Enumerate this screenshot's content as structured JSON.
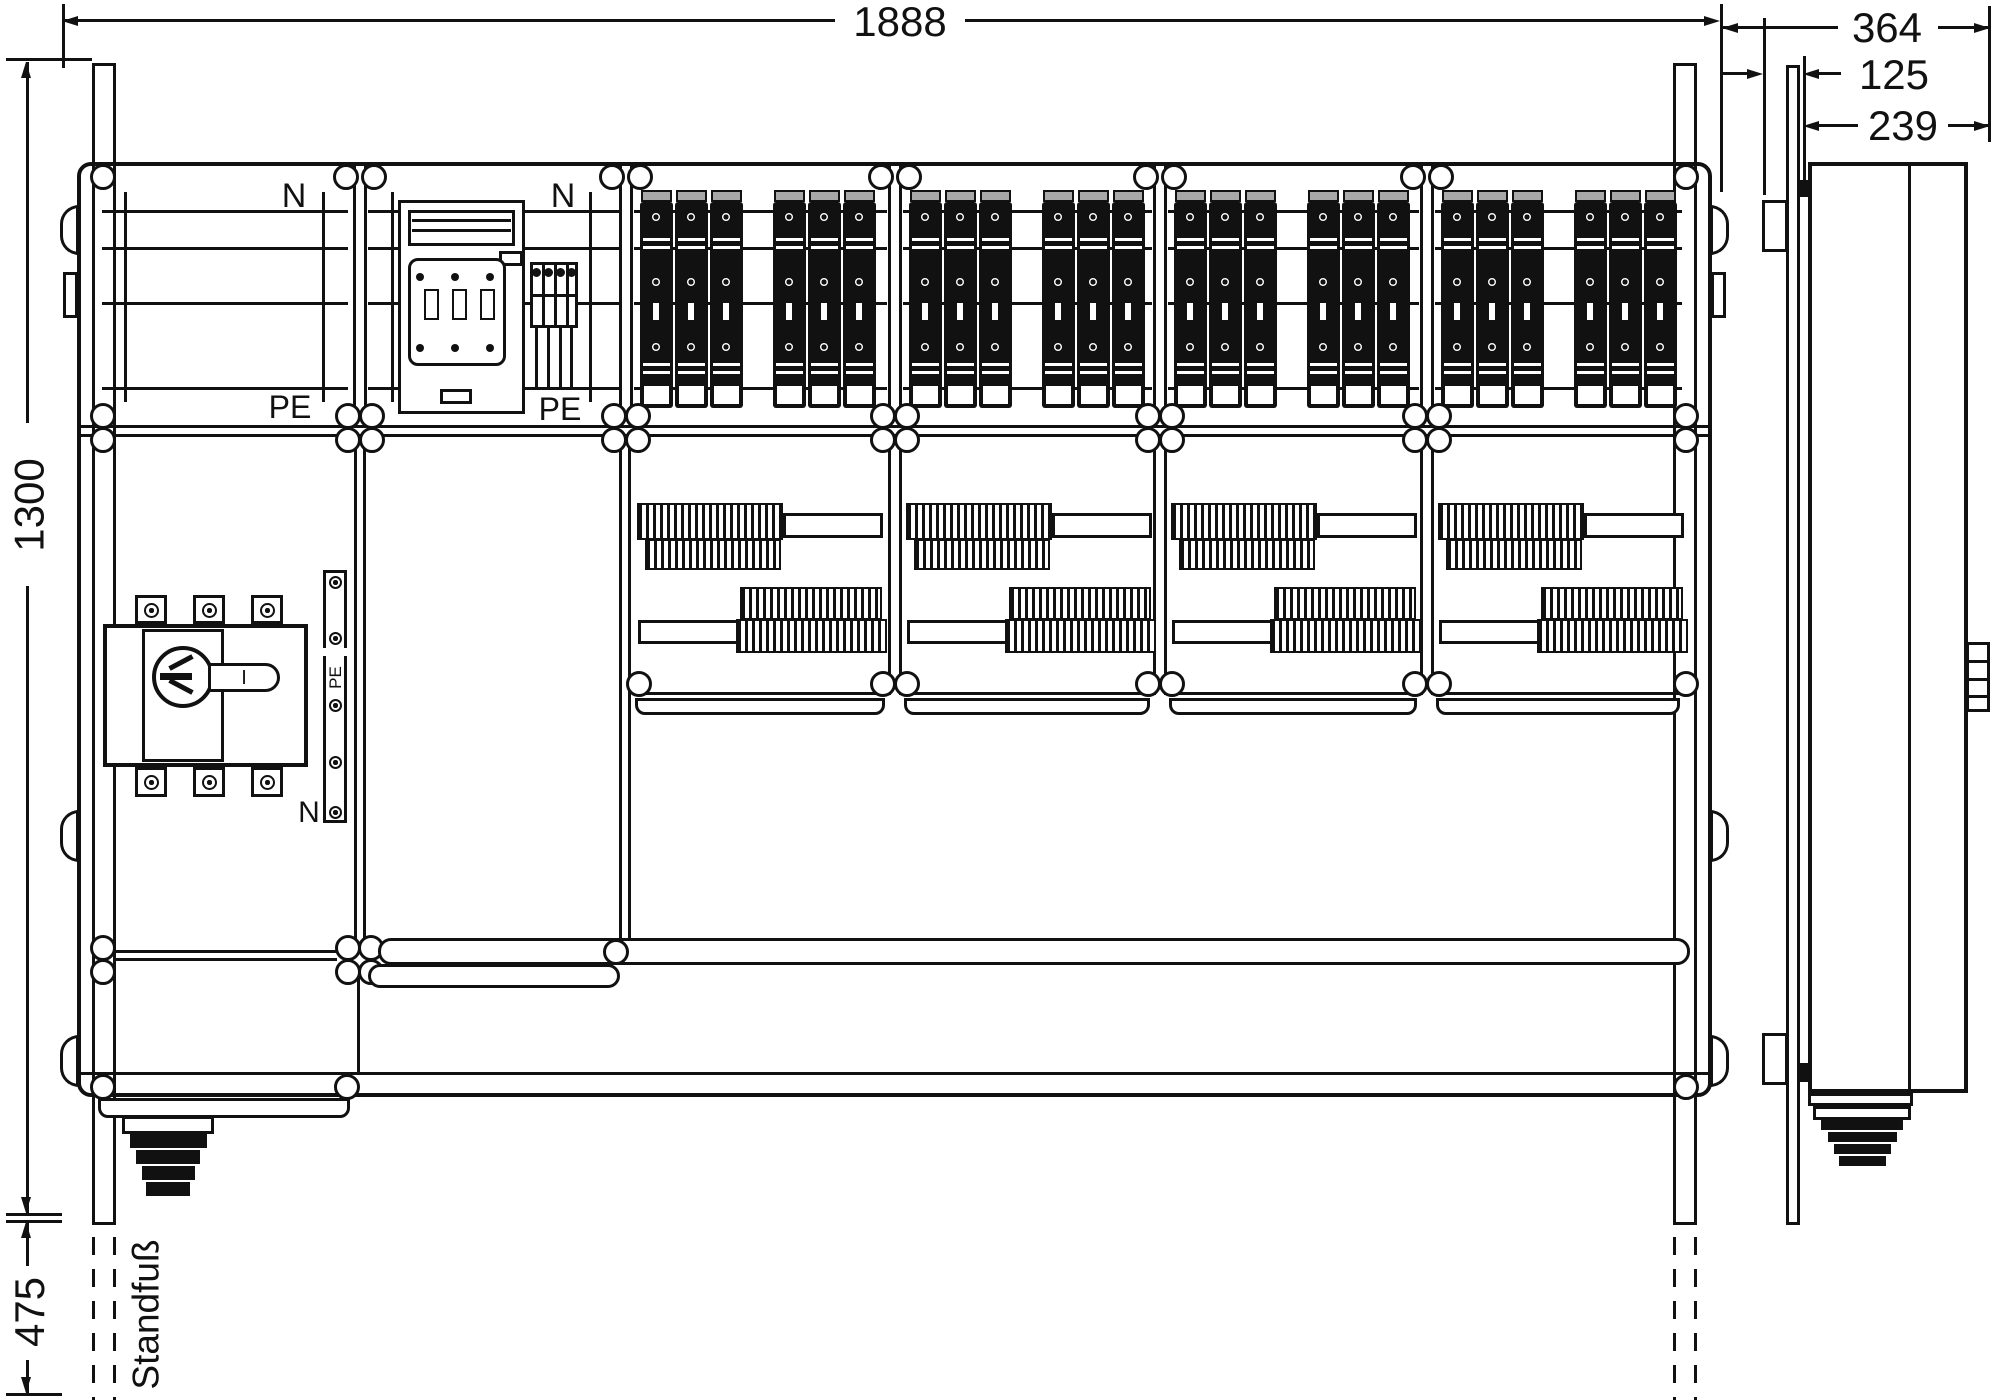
{
  "dimensions": {
    "width": "1888",
    "depth_total": "364",
    "depth_front": "125",
    "depth_body": "239",
    "height": "1300",
    "stand_height": "475"
  },
  "labels": {
    "neutral": "N",
    "protective_earth": "PE",
    "stand": "Standfuß",
    "switch_position": "I"
  },
  "colors": {
    "ink": "#111111",
    "paper": "#ffffff",
    "fuse_cap_gray": "#a8a8a8"
  },
  "structure": {
    "top_row_panels": 6,
    "fuse_field_panels": 4,
    "fuse_groups_per_panel": 2,
    "fuse_rails_per_group": 3,
    "busbars_per_field": 4,
    "distribution_panels": 4,
    "terminal_block_poles": 4,
    "switch_poles": 3
  }
}
